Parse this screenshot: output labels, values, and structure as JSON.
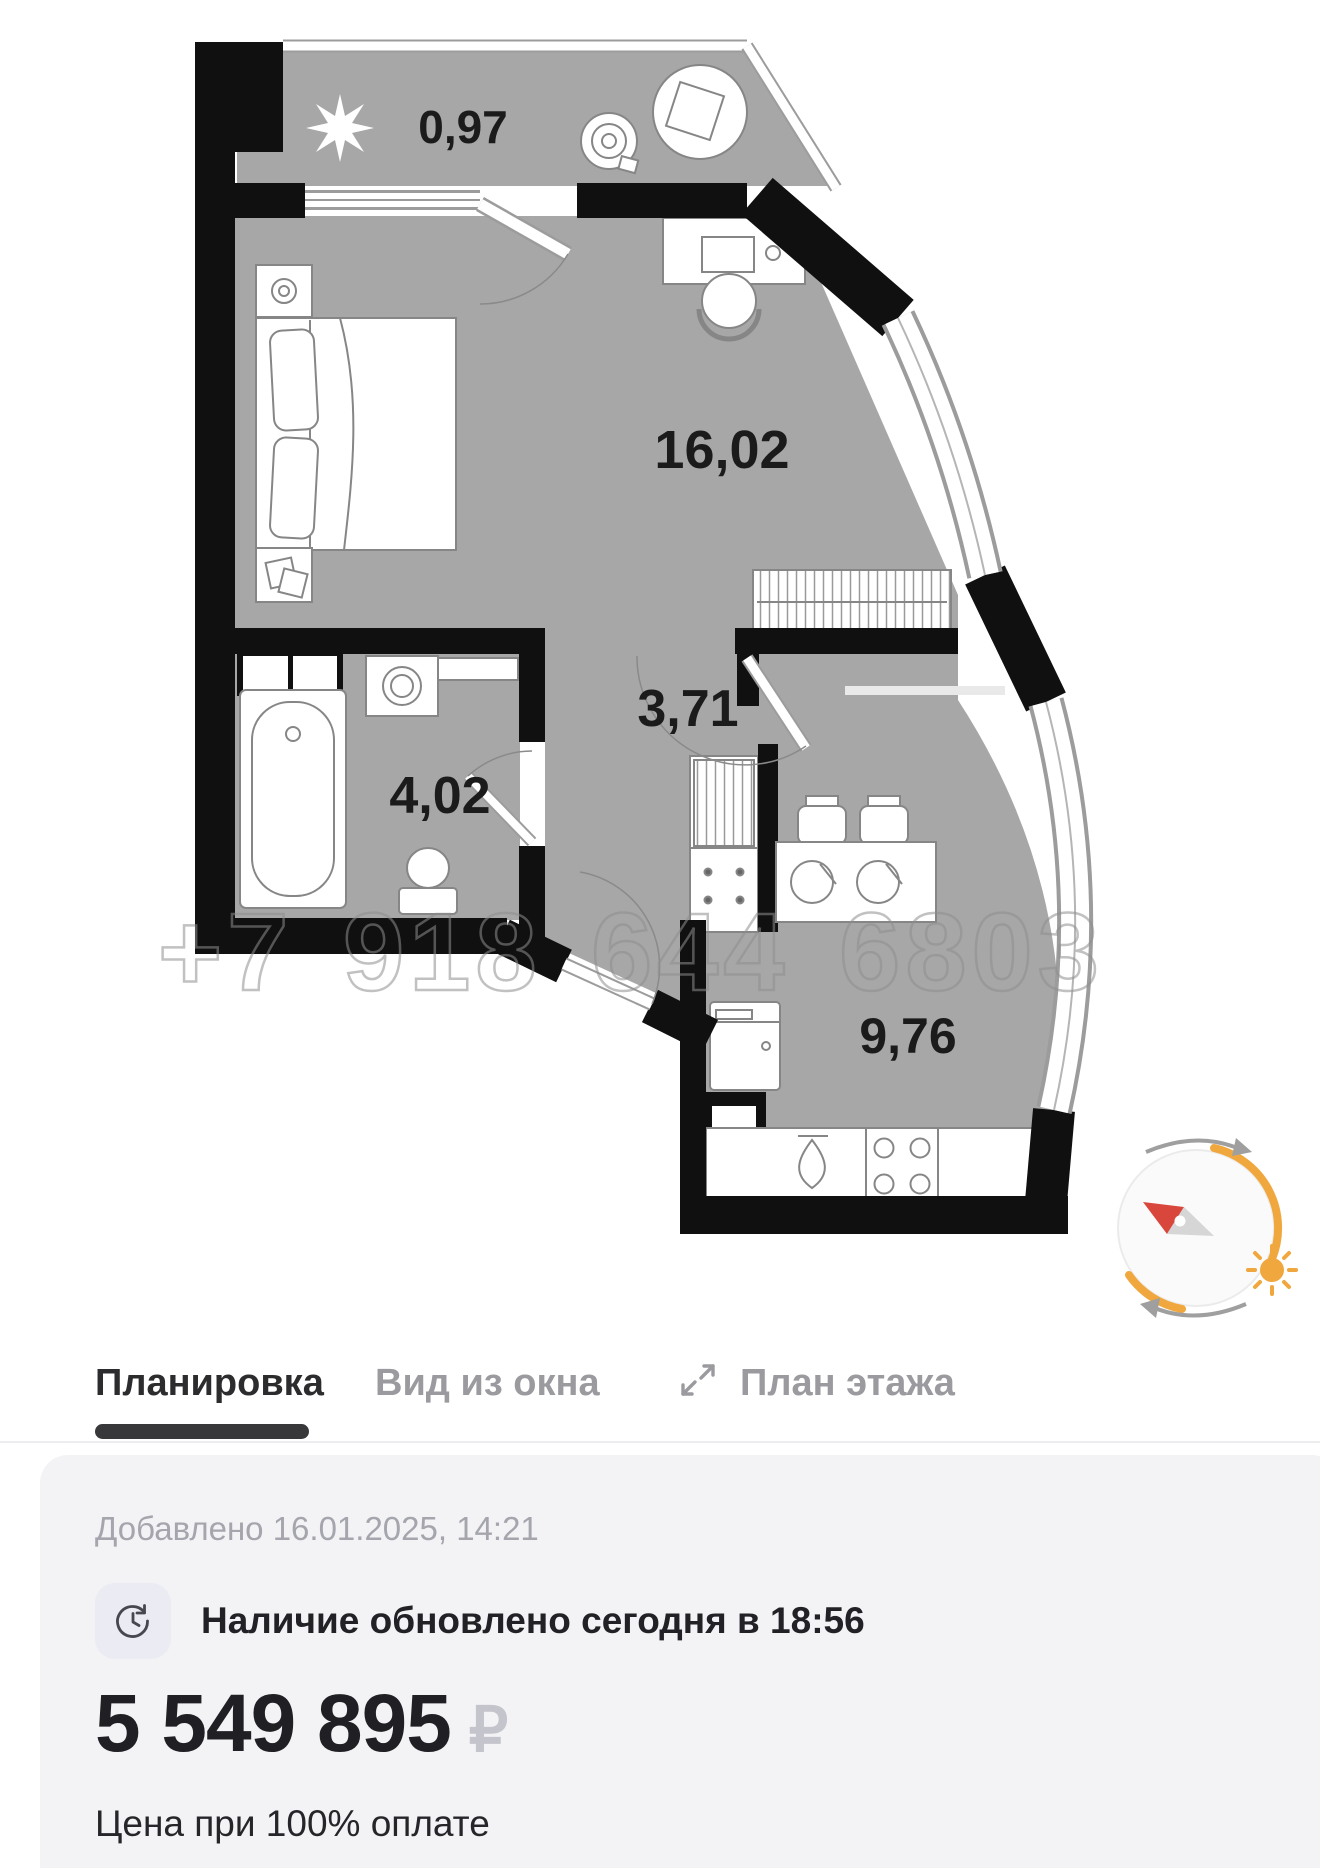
{
  "plan": {
    "watermark": "+7 918 644 6803",
    "areas": {
      "balcony": "0,97",
      "room": "16,02",
      "hall": "3,71",
      "bathroom": "4,02",
      "kitchen": "9,76"
    }
  },
  "tabs": {
    "layout": "Планировка",
    "window_view": "Вид из окна",
    "floor_plan": "План этажа"
  },
  "info": {
    "added": "Добавлено 16.01.2025, 14:21",
    "availability": "Наличие обновлено сегодня в 18:56",
    "price": "5 549 895",
    "currency": "₽",
    "price_note": "Цена при 100% оплате"
  },
  "colors": {
    "floor_gray": "#a7a7a7",
    "wall_black": "#101010",
    "accent_orange": "#F0A73E",
    "needle_red": "#D9473C",
    "tab_active": "#2C2C2E",
    "tab_inactive": "#9B9B9F",
    "card_bg": "#F3F3F5"
  }
}
